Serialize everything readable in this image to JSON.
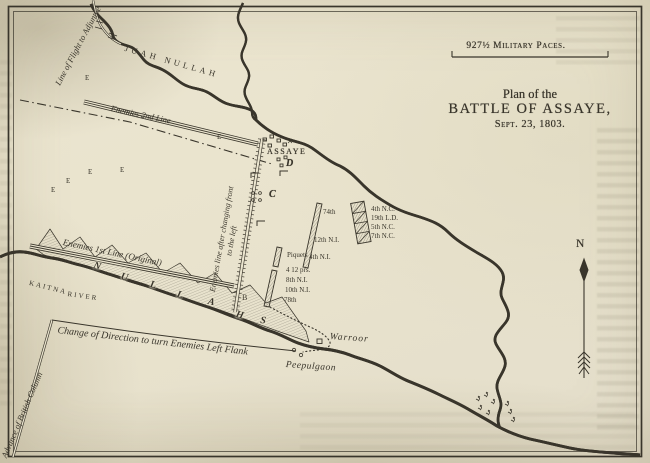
{
  "colors": {
    "paper": "#eae4ce",
    "ink": "#39352b"
  },
  "scale_bar": {
    "label": "927½ Military Paces."
  },
  "title": {
    "line1": "Plan of the",
    "line2": "BATTLE OF ASSAYE,",
    "line3": "Sept. 23, 1803."
  },
  "compass": {
    "north": "N"
  },
  "rivers": {
    "juah": "JUAH NULLAH",
    "kaitna_word1": "KAITNA",
    "kaitna_word2": "RIVER"
  },
  "villages": {
    "assaye": "ASSAYE",
    "warroor": "Warroor",
    "peepulgaon": "Peepulgaon"
  },
  "routes": {
    "advance": "Advance of British Column",
    "change_direction": "Change of Direction to turn Enemies Left Flank",
    "flight": "Line of Flight to Adjuntee"
  },
  "enemy_lines": {
    "first": "Enemies 1st Line (Original)",
    "second": "Enemies 2nd Line",
    "changed_front_1": "Enemies line after changing front",
    "changed_front_2": "to the left"
  },
  "units": {
    "cavalry": [
      {
        "label": "4th N.C."
      },
      {
        "label": "19th L.D."
      },
      {
        "label": "5th N.C."
      },
      {
        "label": "7th N.C."
      }
    ],
    "first_line": [
      {
        "label": "74th"
      },
      {
        "label": "12th N.I."
      },
      {
        "label": "4th N.I."
      }
    ],
    "second_line": [
      {
        "label": "Piquets"
      },
      {
        "label": "4 12 prs."
      },
      {
        "label": "8th N.I."
      },
      {
        "label": "10th N.I."
      },
      {
        "label": "78th"
      }
    ]
  },
  "map_letters": {
    "nullahs": [
      "N",
      "U",
      "L",
      "L",
      "A",
      "H",
      "S"
    ],
    "b": "B",
    "c": "C",
    "d": "D",
    "e_markers": [
      "E",
      "E",
      "E",
      "E",
      "E",
      "E"
    ]
  }
}
